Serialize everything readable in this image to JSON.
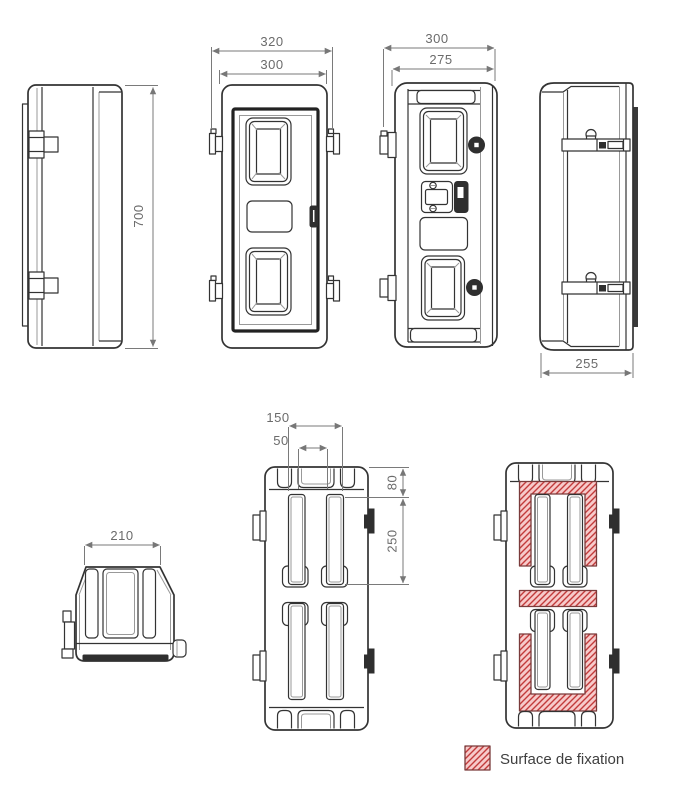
{
  "drawing": {
    "dimensions": {
      "side_left_height": "700",
      "front_outer_width": "320",
      "front_body_width": "300",
      "three_quarter_outer_width": "300",
      "three_quarter_door_width": "275",
      "side_right_depth": "255",
      "top_width": "210",
      "back_slot_span": "150",
      "back_slot_gap": "50",
      "back_top_offset": "80",
      "back_slot_height": "250"
    },
    "legend": {
      "label": "Surface de fixation"
    },
    "colors": {
      "line": "#333333",
      "dimension": "#777777",
      "hatch_fill": "#f7caca",
      "hatch_line": "#c23b3b",
      "hatch_border": "#7a3b3b",
      "dark_fill": "#2f2f2f",
      "strip_fill": "#3a3a3a"
    }
  }
}
